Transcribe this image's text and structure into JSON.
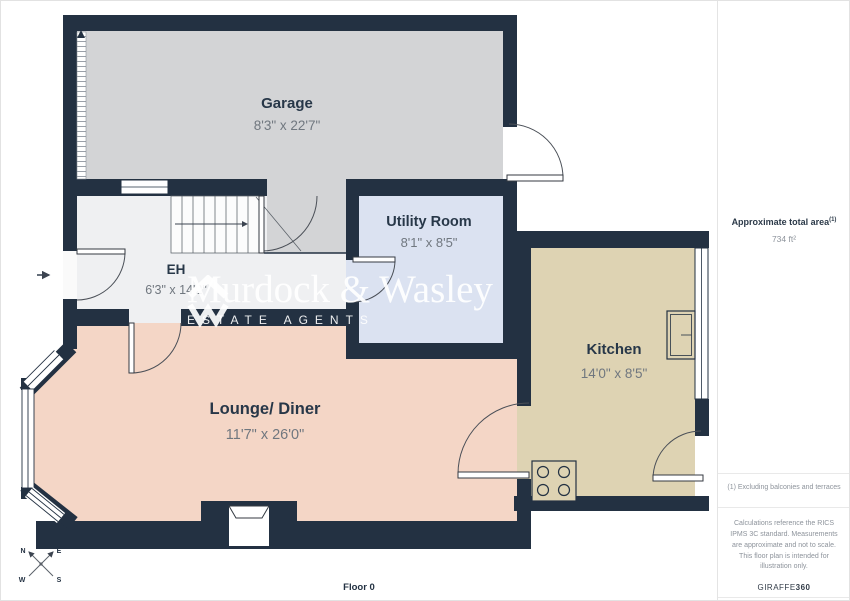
{
  "plan": {
    "floor_label": "Floor 0",
    "rooms": [
      {
        "name": "Garage",
        "dims": "8'3\" x 22'7\""
      },
      {
        "name": "EH",
        "dims": "6'3\" x 14'2\""
      },
      {
        "name": "Utility Room",
        "dims": "8'1\" x 8'5\""
      },
      {
        "name": "Kitchen",
        "dims": "14'0\" x 8'5\""
      },
      {
        "name": "Lounge/ Diner",
        "dims": "11'7\" x 26'0\""
      }
    ],
    "compass": {
      "n": "N",
      "e": "E",
      "s": "S",
      "w": "W"
    },
    "colors": {
      "wall": "#233142",
      "garage_floor": "#d3d4d6",
      "eh_floor": "#eff0f2",
      "utility_floor": "#dbe2f1",
      "kitchen_floor": "#ded3b3",
      "lounge_floor": "#f4d6c6"
    }
  },
  "watermark": {
    "name": "Murdock & Wasley",
    "tagline": "ESTATE AGENTS"
  },
  "sidebar": {
    "total_area_label": "Approximate total area",
    "total_area_superscript": "(1)",
    "total_area_value": "734 ft²",
    "footnote": "(1) Excluding balconies and terraces",
    "disclaimer": "Calculations reference the RICS IPMS 3C standard. Measurements are approximate and not to scale. This floor plan is intended for illustration only.",
    "brand": "GIRAFFE",
    "brand_suffix": "360"
  }
}
